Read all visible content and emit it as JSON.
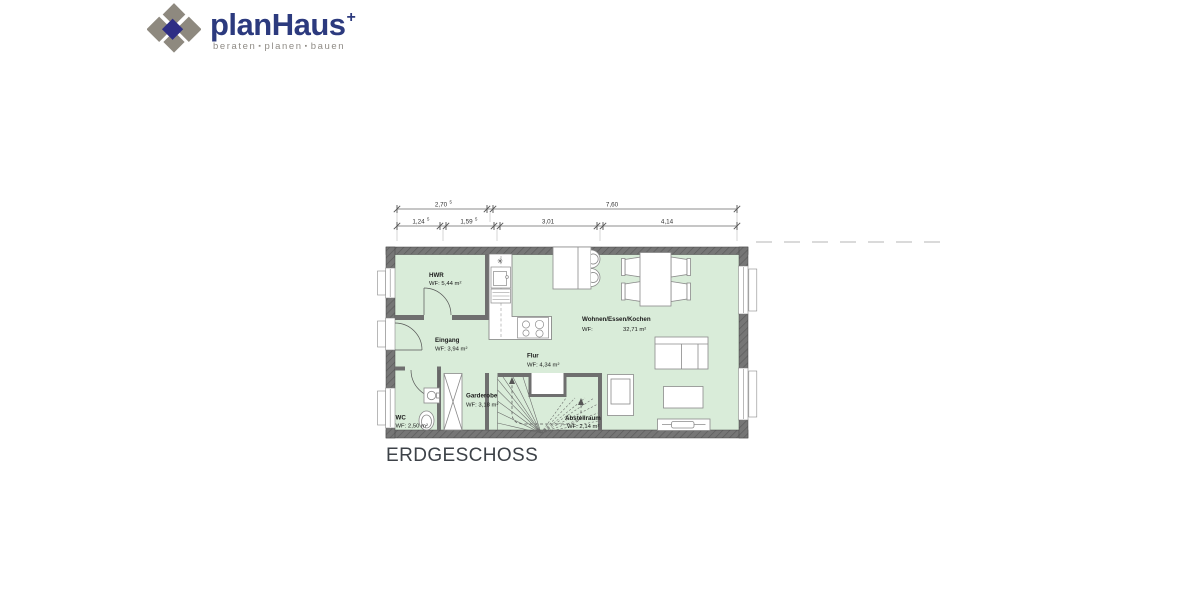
{
  "logo": {
    "brand": "planHaus",
    "plus": "+",
    "tagline": {
      "word1": "beraten",
      "word2": "planen",
      "word3": "bauen",
      "separator": "▪"
    },
    "colors": {
      "brand_navy": "#2c3a7e",
      "mark_gray": "#8e897f",
      "mark_blue": "#2e2e85",
      "tagline_gray": "#8f8b85"
    }
  },
  "floor_plan": {
    "title": "ERDGESCHOSS",
    "rooms": [
      {
        "name": "HWR",
        "area": "WF: 5,44 m²"
      },
      {
        "name": "Eingang",
        "area": "WF: 3,94 m²"
      },
      {
        "name": "WC",
        "area": "WF: 2,50 m²"
      },
      {
        "name": "Garderobe",
        "area": "WF: 3,18 m²"
      },
      {
        "name": "Flur",
        "area": "WF: 4,34 m²"
      },
      {
        "name": "Abstellraum",
        "area": "WF: 2,14 m²"
      },
      {
        "name": "Wohnen/Essen/Kochen",
        "area_label": "WF:",
        "area_value": "32,71 m²"
      }
    ],
    "dimensions": {
      "row1": [
        {
          "value": "2,70",
          "sup": "5"
        },
        {
          "value": "7,60",
          "sup": ""
        }
      ],
      "row2": [
        {
          "value": "1,24",
          "sup": "5"
        },
        {
          "value": "1,59",
          "sup": "5"
        },
        {
          "value": "3,01",
          "sup": ""
        },
        {
          "value": "4,14",
          "sup": ""
        }
      ]
    },
    "symbols": {
      "kitchen_marker": "✳"
    },
    "colors": {
      "floor_green": "#d9ecd9",
      "wall_gray": "#6f6f6f"
    }
  }
}
